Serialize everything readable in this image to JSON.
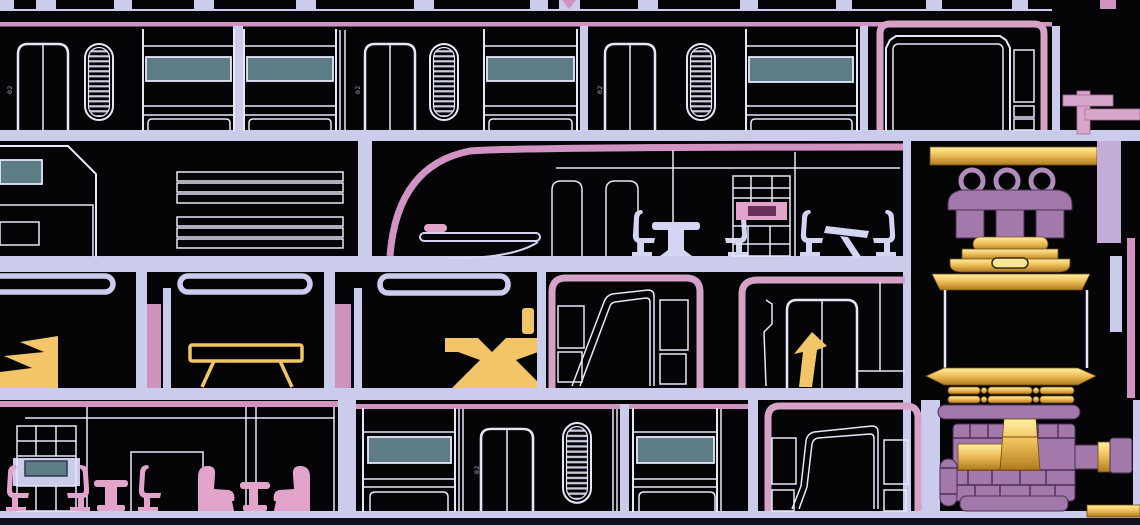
{
  "scene": {
    "type": "starship-deck-cutaway-blueprint",
    "decks_visible": 4
  },
  "labels": {
    "door_plates": [
      "02",
      "02",
      "02",
      "02"
    ]
  },
  "palette": {
    "room_black": "#050508",
    "deck_lavender": "#cbcbec",
    "outline_white": "#e7e7f8",
    "line_pink": "#d093c2",
    "pink_border": "#d6a3c6",
    "furniture_pink": "#e2a4cb",
    "pink_deep": "#6b2f5c",
    "pillar_pink": "#cf92bd",
    "furniture_lavender": "#d3d5f3",
    "screen_teal": "#5c7d86",
    "gold_furniture": "#f2c568",
    "gold_pale": "#ffefa3",
    "gold_mid": "#eec05a",
    "gold_deep": "#b17a1e",
    "gold_edge": "#6e4a0e",
    "machine_purple": "#a379ab",
    "machine_purple_light": "#bb92c3",
    "machine_dark": "#4a2f52",
    "ring_mauve": "#b08cba",
    "core_pillar": "#c4aed8",
    "bottom_navy": "#10101f",
    "label_gray": "#9d9dbb"
  }
}
